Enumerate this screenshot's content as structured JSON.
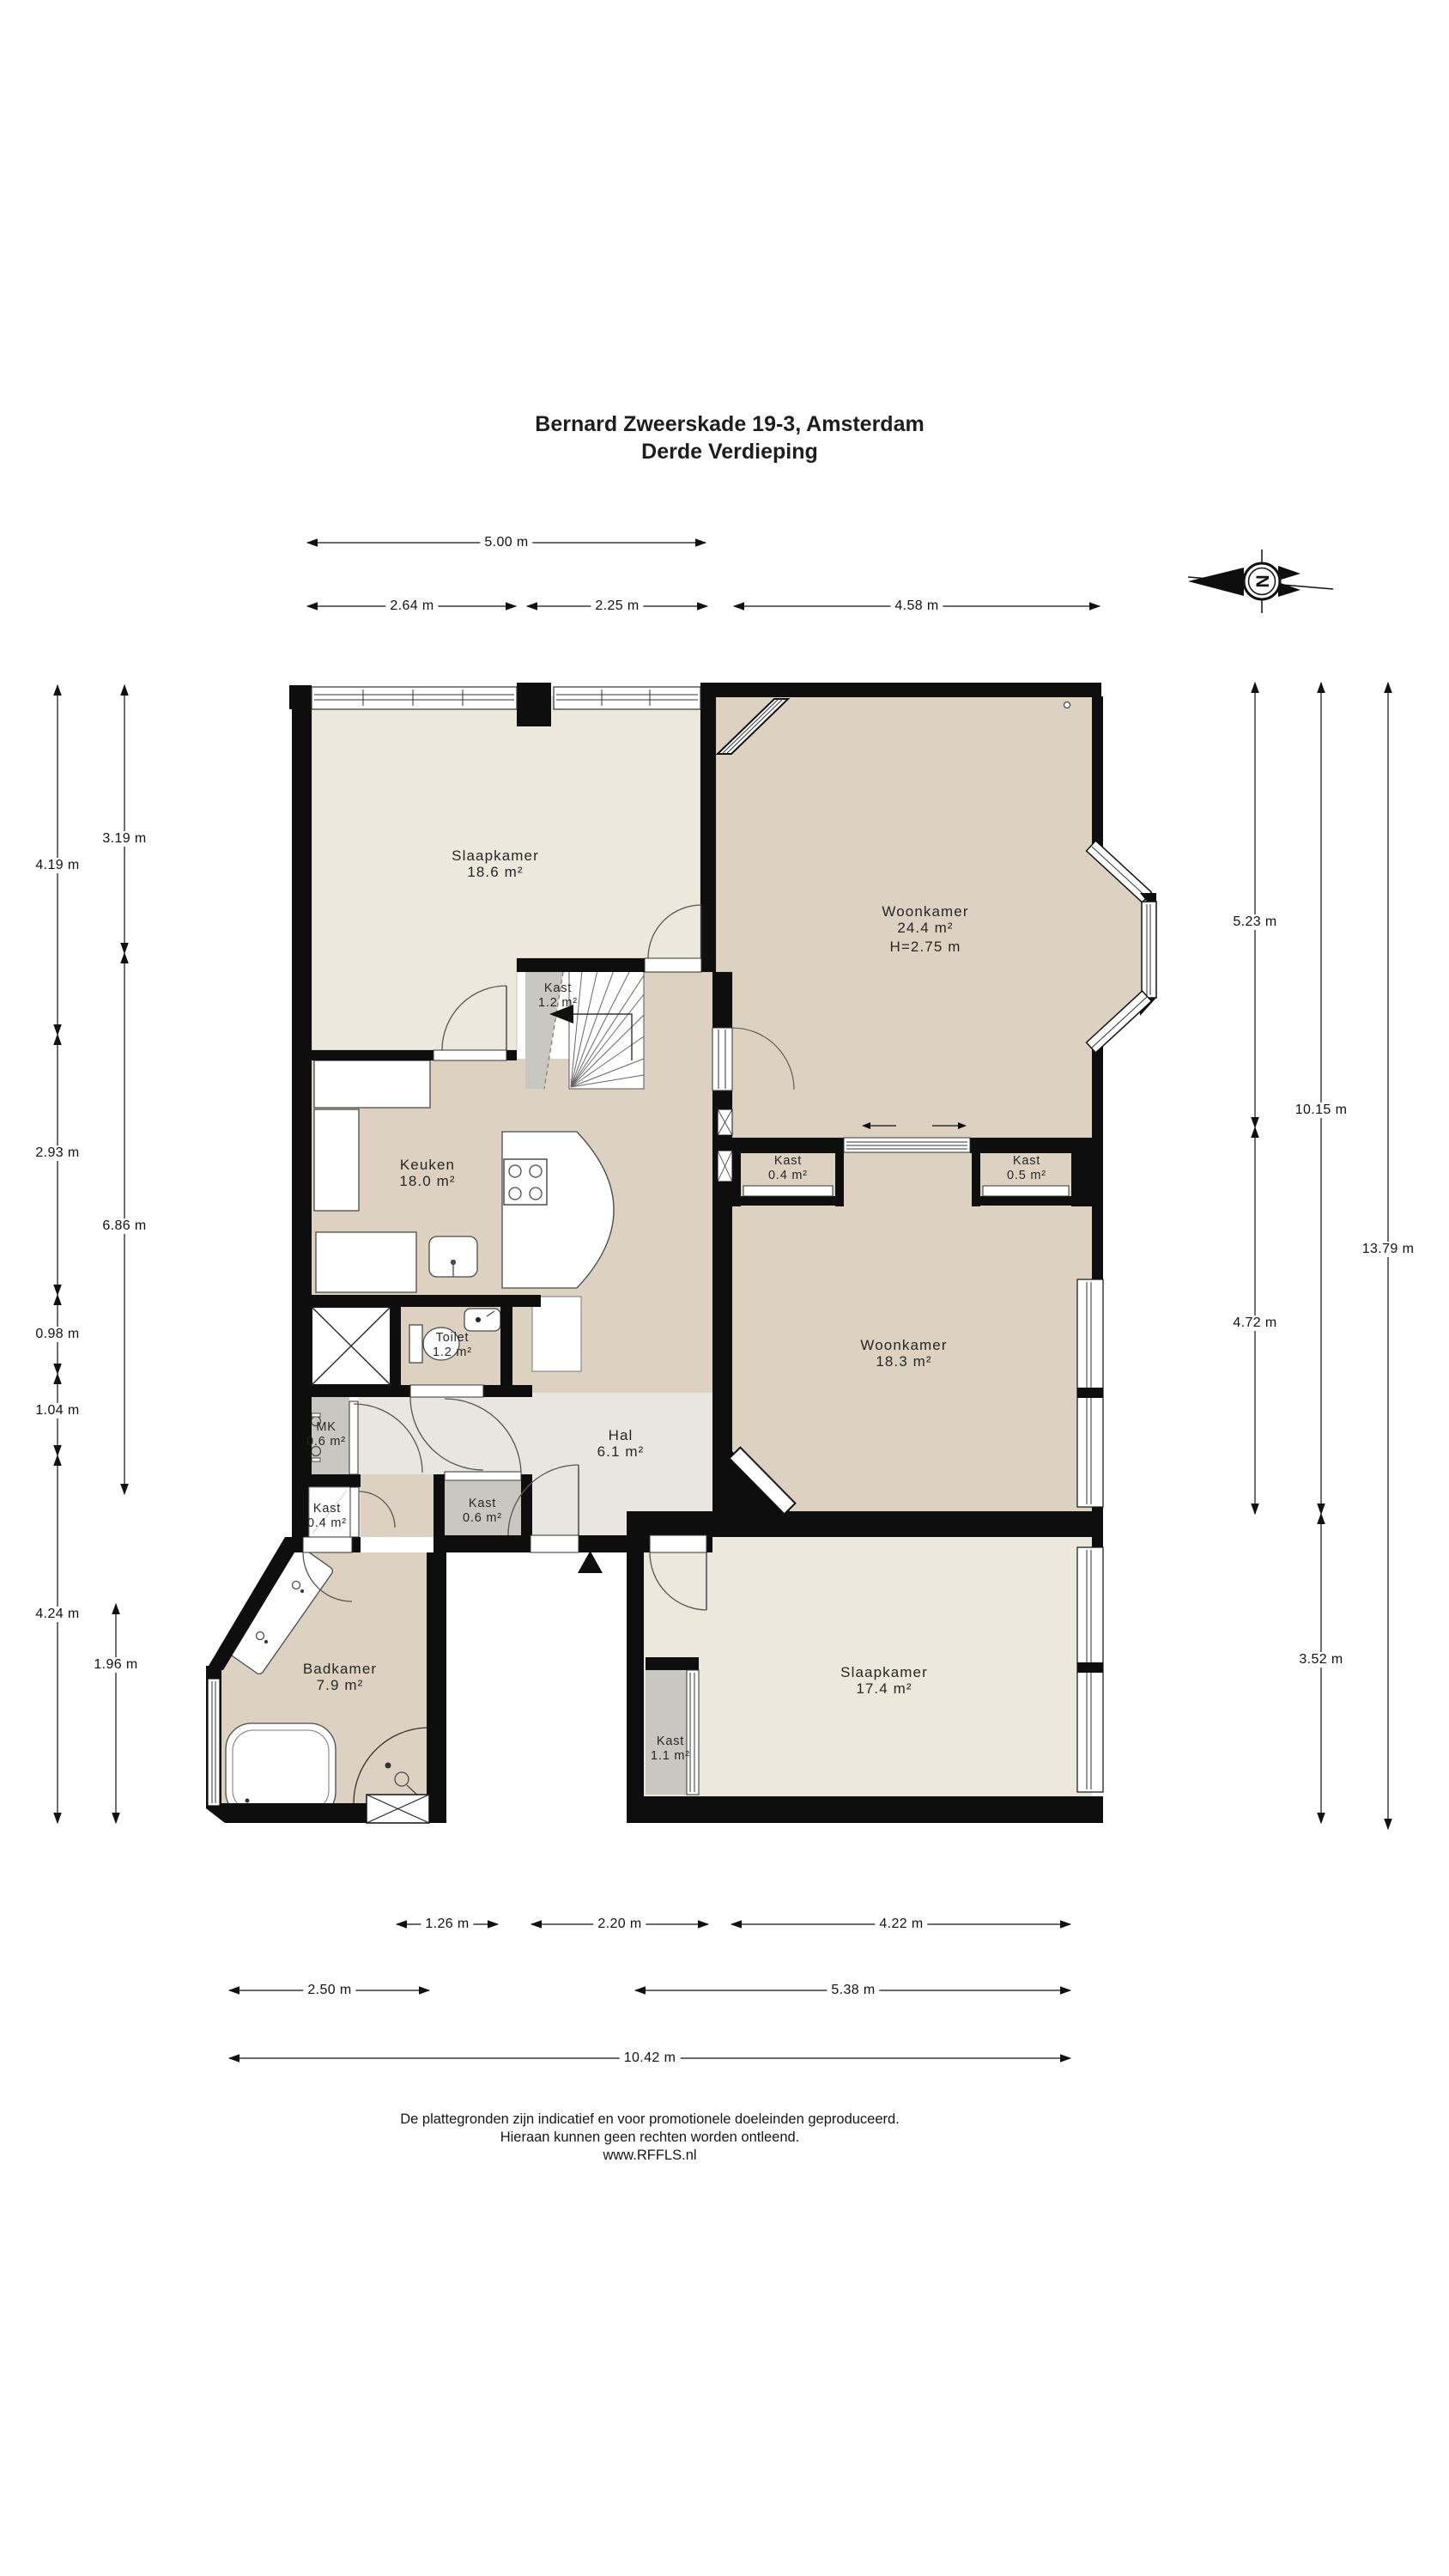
{
  "title": {
    "line1": "Bernard Zweerskade 19-3, Amsterdam",
    "line2": "Derde Verdieping"
  },
  "compass": {
    "letter": "N"
  },
  "rooms": [
    {
      "id": "slaapkamer-1",
      "name": "Slaapkamer",
      "area": "18.6 m²"
    },
    {
      "id": "woonkamer-1",
      "name": "Woonkamer",
      "area": "24.4 m²",
      "height": "H=2.75 m"
    },
    {
      "id": "kast-trap",
      "name": "Kast",
      "area": "1.2 m²"
    },
    {
      "id": "keuken",
      "name": "Keuken",
      "area": "18.0 m²"
    },
    {
      "id": "kast-woonkamer-links",
      "name": "Kast",
      "area": "0.4 m²"
    },
    {
      "id": "kast-woonkamer-rechts",
      "name": "Kast",
      "area": "0.5 m²"
    },
    {
      "id": "woonkamer-2",
      "name": "Woonkamer",
      "area": "18.3 m²"
    },
    {
      "id": "toilet",
      "name": "Toilet",
      "area": "1.2 m²"
    },
    {
      "id": "meterkast",
      "name": "MK",
      "area": "0.6 m²"
    },
    {
      "id": "hal",
      "name": "Hal",
      "area": "6.1 m²"
    },
    {
      "id": "kast-hal-links",
      "name": "Kast",
      "area": "0.4 m²"
    },
    {
      "id": "kast-hal-rechts",
      "name": "Kast",
      "area": "0.6 m²"
    },
    {
      "id": "badkamer",
      "name": "Badkamer",
      "area": "7.9 m²"
    },
    {
      "id": "slaapkamer-2",
      "name": "Slaapkamer",
      "area": "17.4 m²"
    },
    {
      "id": "kast-slaapkamer",
      "name": "Kast",
      "area": "1.1 m²"
    }
  ],
  "dimensions": {
    "top": [
      "5.00 m",
      "2.64 m",
      "2.25 m",
      "4.58 m"
    ],
    "left_outer": [
      "4.19 m",
      "2.93 m",
      "0.98 m",
      "1.04 m",
      "4.24 m"
    ],
    "left_inner": [
      "3.19 m",
      "6.86 m",
      "1.96 m"
    ],
    "right_inner": [
      "5.23 m",
      "4.72 m"
    ],
    "right_middle": [
      "10.15 m",
      "3.52 m"
    ],
    "right_outer": [
      "13.79 m"
    ],
    "bottom_row1": [
      "1.26 m",
      "2.20 m",
      "4.22 m"
    ],
    "bottom_row2": [
      "2.50 m",
      "5.38 m"
    ],
    "bottom_row3": [
      "10.42 m"
    ]
  },
  "footer": {
    "line1": "De plattegronden zijn indicatief en voor promotionele doeleinden geproduceerd.",
    "line2": "Hieraan kunnen geen rechten worden ontleend.",
    "line3": "www.RFFLS.nl"
  }
}
